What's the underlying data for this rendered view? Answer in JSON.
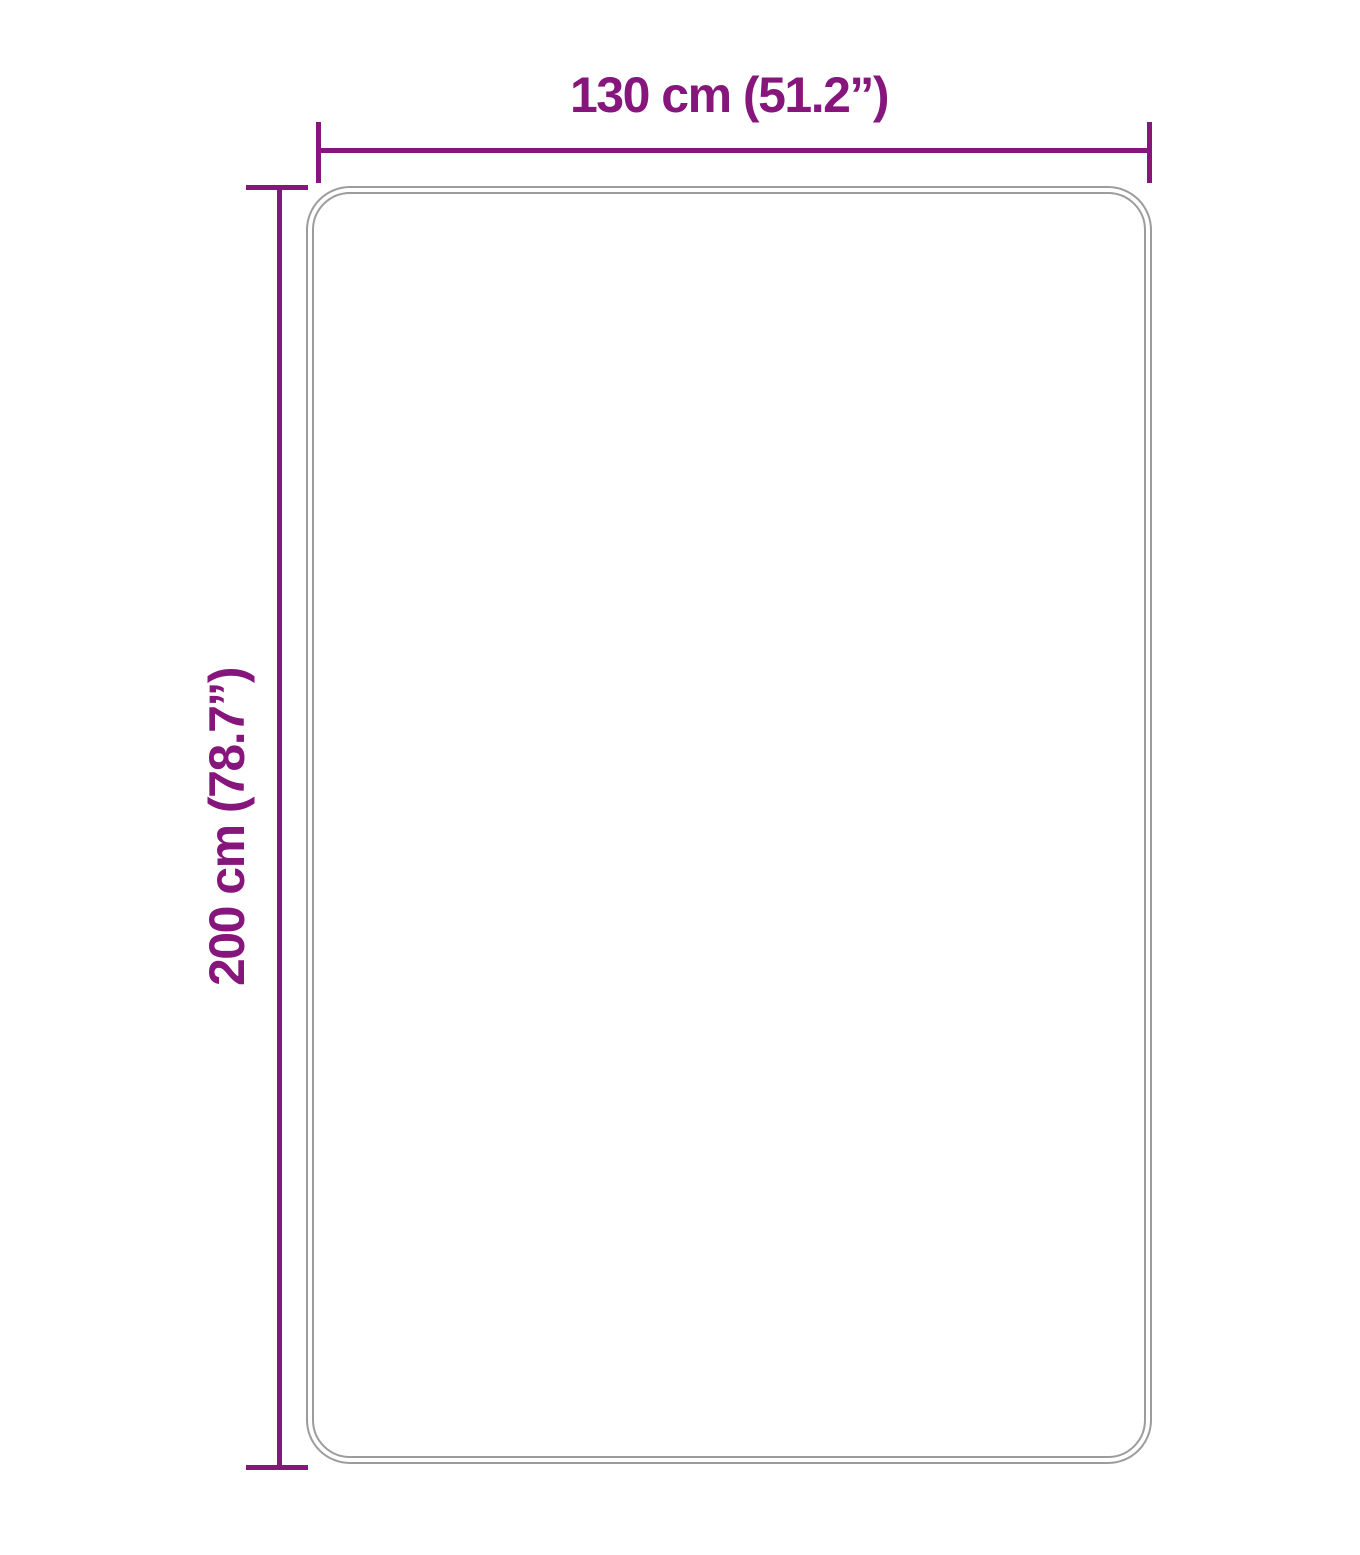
{
  "diagram": {
    "kind": "product-dimension-diagram",
    "shape": "rounded-rectangle-rug-outline",
    "width": {
      "label": "130 cm (51.2”)",
      "value_cm": 130,
      "value_in": 51.2
    },
    "height": {
      "label": "200 cm (78.7”)",
      "value_cm": 200,
      "value_in": 78.7
    },
    "colors": {
      "dimension": "#86157C",
      "outline": "#9C9C9C",
      "background": "#FFFFFF"
    }
  }
}
